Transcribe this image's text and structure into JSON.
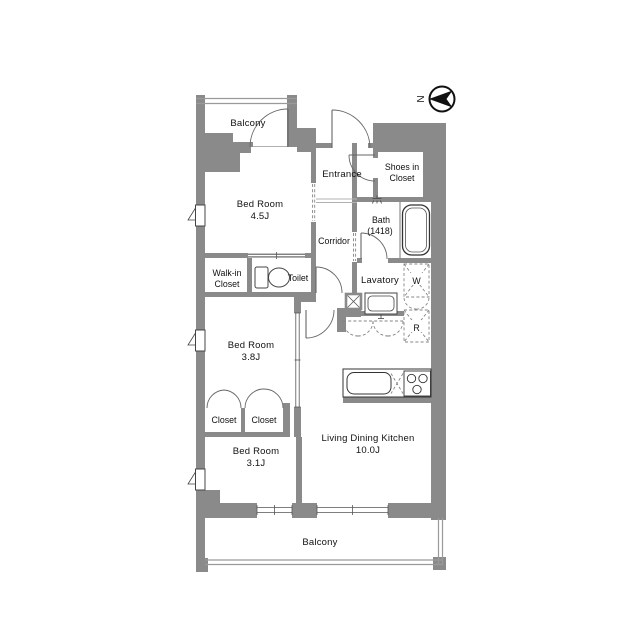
{
  "compass": {
    "label": "N"
  },
  "rooms": {
    "balcony_top": {
      "label": "Balcony"
    },
    "bedroom_45": {
      "name": "Bed Room",
      "size": "4.5J"
    },
    "entrance": {
      "label": "Entrance"
    },
    "shoes_in_closet": {
      "line1": "Shoes in",
      "line2": "Closet"
    },
    "bath": {
      "name": "Bath",
      "size": "(1418)"
    },
    "corridor": {
      "label": "Corridor"
    },
    "walk_in_closet": {
      "line1": "Walk-in",
      "line2": "Closet"
    },
    "toilet": {
      "label": "Toilet"
    },
    "lavatory": {
      "label": "Lavatory"
    },
    "washer": {
      "label": "W"
    },
    "refrigerator": {
      "label": "R"
    },
    "bedroom_38": {
      "name": "Bed Room",
      "size": "3.8J"
    },
    "closet_left": {
      "label": "Closet"
    },
    "closet_right": {
      "label": "Closet"
    },
    "bedroom_31": {
      "name": "Bed Room",
      "size": "3.1J"
    },
    "ldk": {
      "name": "Living Dining Kitchen",
      "size": "10.0J"
    },
    "balcony_bottom": {
      "label": "Balcony"
    }
  },
  "colors": {
    "wall": "#8a8a8a",
    "fixture_line": "#555555",
    "text": "#111111"
  }
}
